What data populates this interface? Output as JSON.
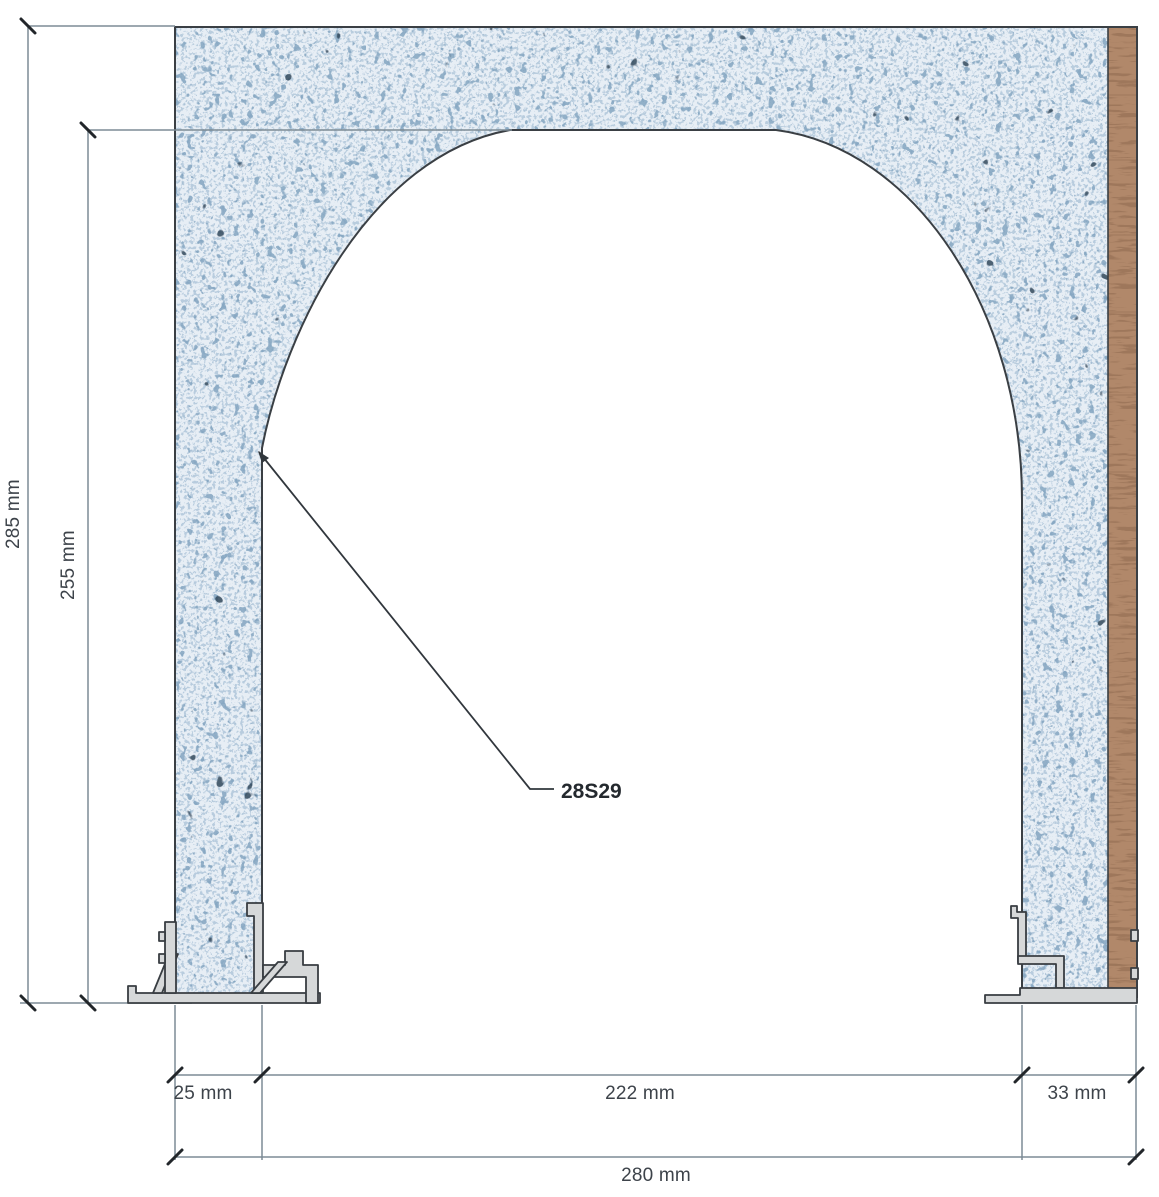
{
  "labels": {
    "overall_height": "285 mm",
    "opening_height": "255 mm",
    "left_jamb_width": "25 mm",
    "opening_width": "222 mm",
    "right_jamb_width": "33 mm",
    "overall_width": "280 mm",
    "part_code": "28S29"
  },
  "colors": {
    "wall_base": "#e7eef5",
    "speckle_light": "#b4c9dc",
    "speckle_mid": "#7da0bd",
    "speckle_dark": "#33485c",
    "wood": "#b1886a",
    "wood_grain": "#8f6a50",
    "outline": "#3a3f44",
    "dimension_line": "#7d8b95",
    "tick": "#22262a",
    "profile_fill": "#d6d8d9",
    "text": "#3d434a"
  }
}
